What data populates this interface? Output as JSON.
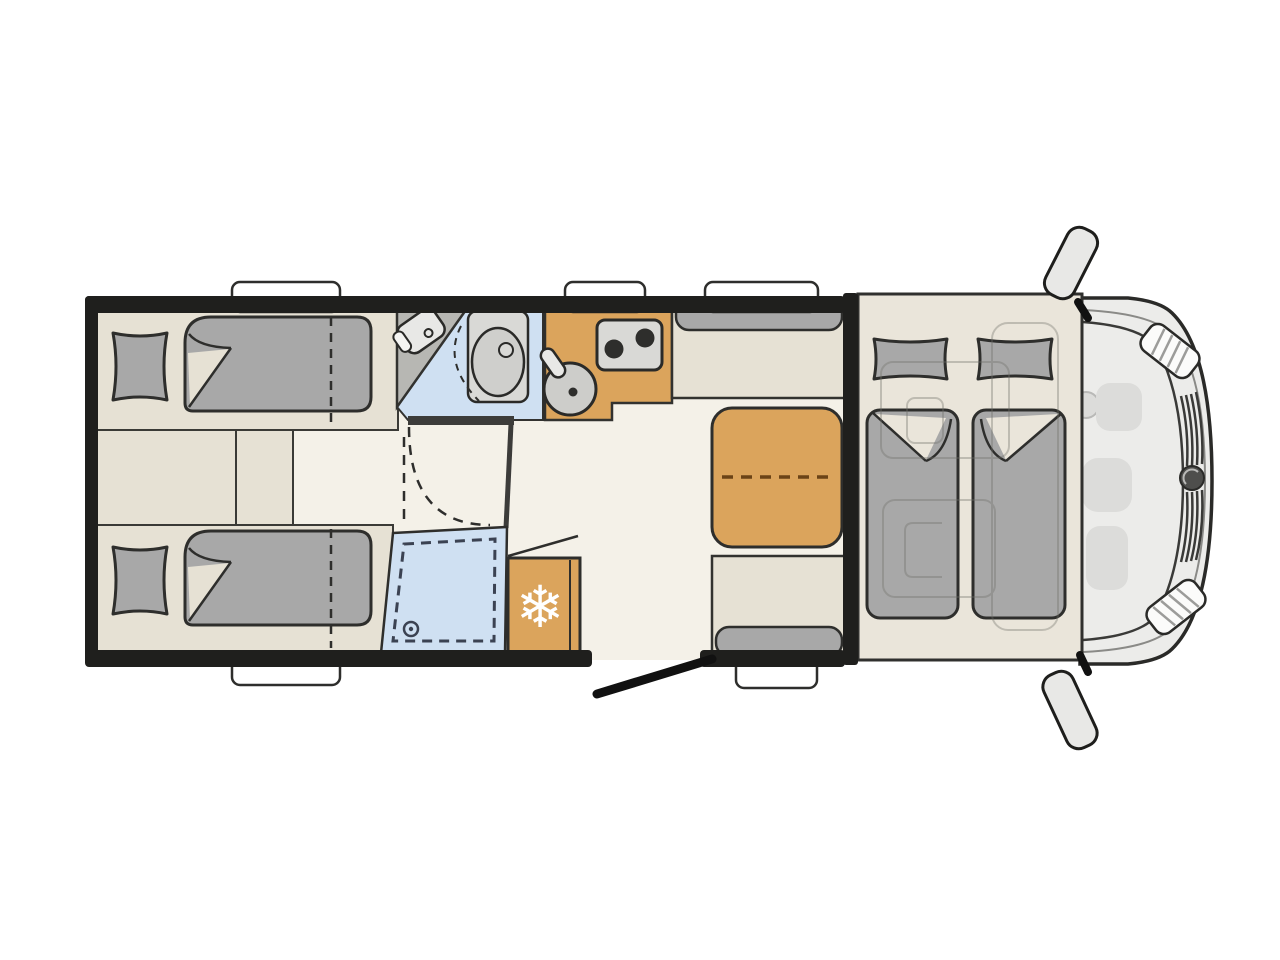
{
  "page": {
    "background": "#ffffff",
    "description": "Top-down floor plan of a motorhome"
  },
  "floorplan": {
    "vehicle": "motorhome",
    "view": "top-down",
    "zones": [
      "rear-twin-single-beds",
      "between-beds-step",
      "bathroom-with-vanity-and-toilet",
      "shower-cubicle",
      "kitchen-with-stove-and-sink",
      "refrigerator",
      "dinette-with-folding-table",
      "entry-door-open",
      "drop-down-bed-over-cab",
      "driver-cab-with-swivel-seats"
    ],
    "window_count": 5,
    "mirror_count": 2
  },
  "icons": {
    "snowflake_glyph": "❄"
  },
  "colors": {
    "wall": "#1f1f1d",
    "floor": "#f4f1e8",
    "platform": "#e6e1d4",
    "overcab_platform": "#eae5da",
    "soft_gray": "#a8a8a8",
    "fixture_gray": "#d9d9d6",
    "counter_gray": "#b7b7b3",
    "sink_gray": "#cdcdca",
    "wood_orange": "#dba45c",
    "wet_blue": "#cfe0f2",
    "cab_body": "#ececea",
    "cab_detail": "#dcdcda",
    "outline": "#2e2e2c",
    "window_white": "#ffffff",
    "mirror_gray": "#e8e8e6",
    "burner_dark": "#2e2e2c",
    "table_fold_line": "#6b4316",
    "shower_dash": "#3b4252",
    "snowflake_white": "#ffffff",
    "logo_gray": "#4e4e4c",
    "faint_outline": "#6f6f68",
    "door_black": "#111111",
    "inner_wall_gray": "#3c3c3a"
  }
}
